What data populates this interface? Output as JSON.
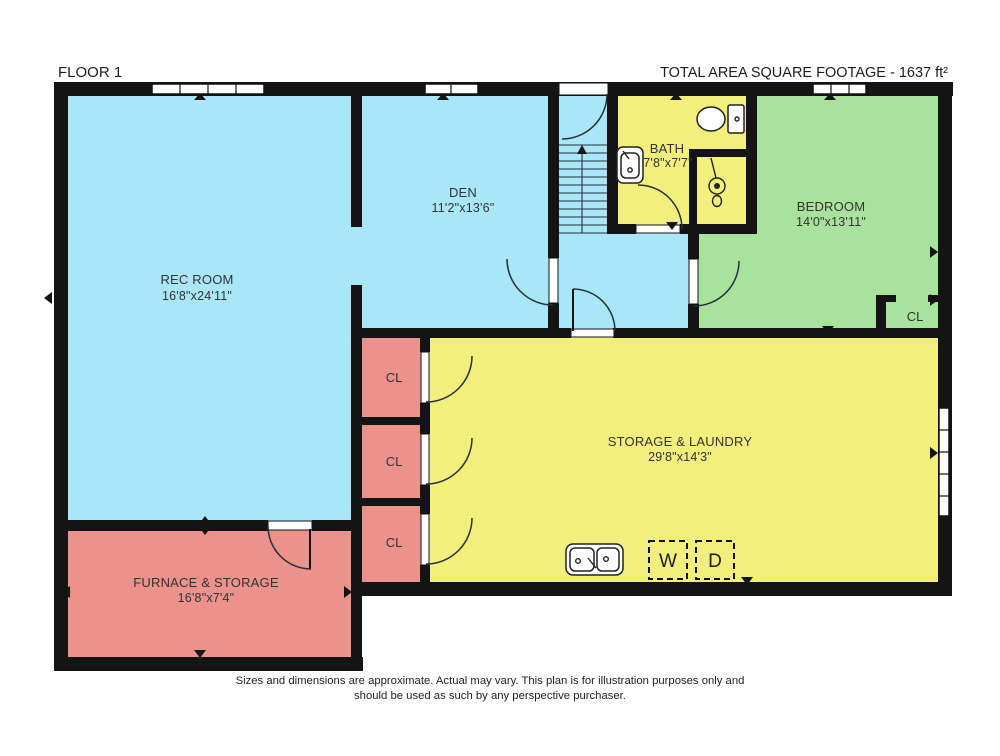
{
  "header": {
    "floor_label": "FLOOR 1",
    "total_area_label": "TOTAL AREA SQUARE FOOTAGE - 1637 ft²"
  },
  "rooms": {
    "rec_room": {
      "name": "REC ROOM",
      "dims": "16'8\"x24'11\""
    },
    "den": {
      "name": "DEN",
      "dims": "11'2\"x13'6\""
    },
    "bath": {
      "name": "BATH",
      "dims": "7'8\"x7'7\""
    },
    "bedroom": {
      "name": "BEDROOM",
      "dims": "14'0\"x13'11\""
    },
    "storage_laundry": {
      "name": "STORAGE & LAUNDRY",
      "dims": "29'8\"x14'3\""
    },
    "furnace_storage": {
      "name": "FURNACE & STORAGE",
      "dims": "16'8\"x7'4\""
    },
    "bedroom_closet": {
      "name": "CL"
    },
    "closet_1": {
      "name": "CL"
    },
    "closet_2": {
      "name": "CL"
    },
    "closet_3": {
      "name": "CL"
    }
  },
  "appliances": {
    "washer": "W",
    "dryer": "D"
  },
  "footer": {
    "disclaimer_line1": "Sizes and dimensions are approximate. Actual may vary. This plan is for illustration purposes only and",
    "disclaimer_line2": "should be used as such by any perspective purchaser."
  },
  "colors": {
    "room_blue": "#a9e6f8",
    "room_yellow": "#f2ef7d",
    "room_green": "#a9e29d",
    "room_red": "#ea928b",
    "wall": "#141414",
    "text": "#333333"
  }
}
